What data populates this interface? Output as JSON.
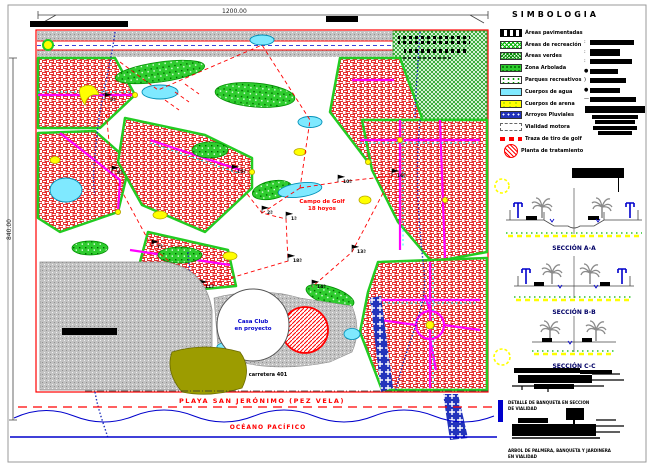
{
  "sheet": {
    "dim_top": "1200.00",
    "dim_left": "840.00",
    "colors": {
      "plan_border": "#ff0000",
      "road_magenta": "#ff00ff",
      "water_cyan": "#7fe9ff",
      "sand_yellow": "#ffff00",
      "stream_blue": "#2233bb",
      "tree_green": "#2ecc2e",
      "paved_gray": "#c4c4c4",
      "golf_trace_red": "#ff0000",
      "beach_olive": "#9c9c00"
    }
  },
  "plan": {
    "golf_label_line1": "Campo de Golf",
    "golf_label_line2": "18 hoyos",
    "casa_club_line1": "Casa Club",
    "casa_club_line2": "en proyecto",
    "road_label": "carretera 401",
    "beach_label": "PLAYA SAN JERÓNIMO (PEZ VELA)",
    "ocean_label": "OCÉANO PACÍFICO",
    "holes": [
      {
        "label": "5ª"
      },
      {
        "label": "8ª"
      },
      {
        "label": "15ª"
      },
      {
        "label": "2ª"
      },
      {
        "label": "1ª"
      },
      {
        "label": "18ª"
      },
      {
        "label": "11ª"
      },
      {
        "label": "14ª"
      },
      {
        "label": "10ª"
      },
      {
        "label": "16ª"
      },
      {
        "label": "13ª"
      },
      {
        "label": "7ª"
      }
    ]
  },
  "legend": {
    "title": "SIMBOLOGIA",
    "items": [
      {
        "label": "Áreas pavimentadas",
        "swatch": "paved"
      },
      {
        "label": "Áreas de recreación",
        "swatch": "recreation"
      },
      {
        "label": "Áreas verdes",
        "swatch": "verdes"
      },
      {
        "label": "Zona Arbolada",
        "swatch": "arbolada"
      },
      {
        "label": "Parques recreativos",
        "swatch": "parques"
      },
      {
        "label": "Cuerpos de agua",
        "swatch": "agua"
      },
      {
        "label": "Cuerpos de arena",
        "swatch": "arena"
      },
      {
        "label": "Arroyos Pluviales",
        "swatch": "arroyos"
      },
      {
        "label": "Vialidad motora",
        "swatch": "vialidad"
      },
      {
        "label": "Traza de tiro de golf",
        "swatch": "golf"
      },
      {
        "label": "Planta de tratamiento",
        "swatch": "planta"
      }
    ]
  },
  "sections": [
    {
      "label": "SECCIÓN A-A"
    },
    {
      "label": "SECCIÓN B-B"
    },
    {
      "label": "SECCIÓN C-C"
    }
  ],
  "details": [
    {
      "caption_line1": "DETALLE DE BANQUETA EN SECCION",
      "caption_line2": "DE VIALIDAD"
    },
    {
      "caption_line1": "ARBOL DE PALMERA, BANQUETA Y JARDINERA",
      "caption_line2": "EN VIALIDAD"
    }
  ]
}
